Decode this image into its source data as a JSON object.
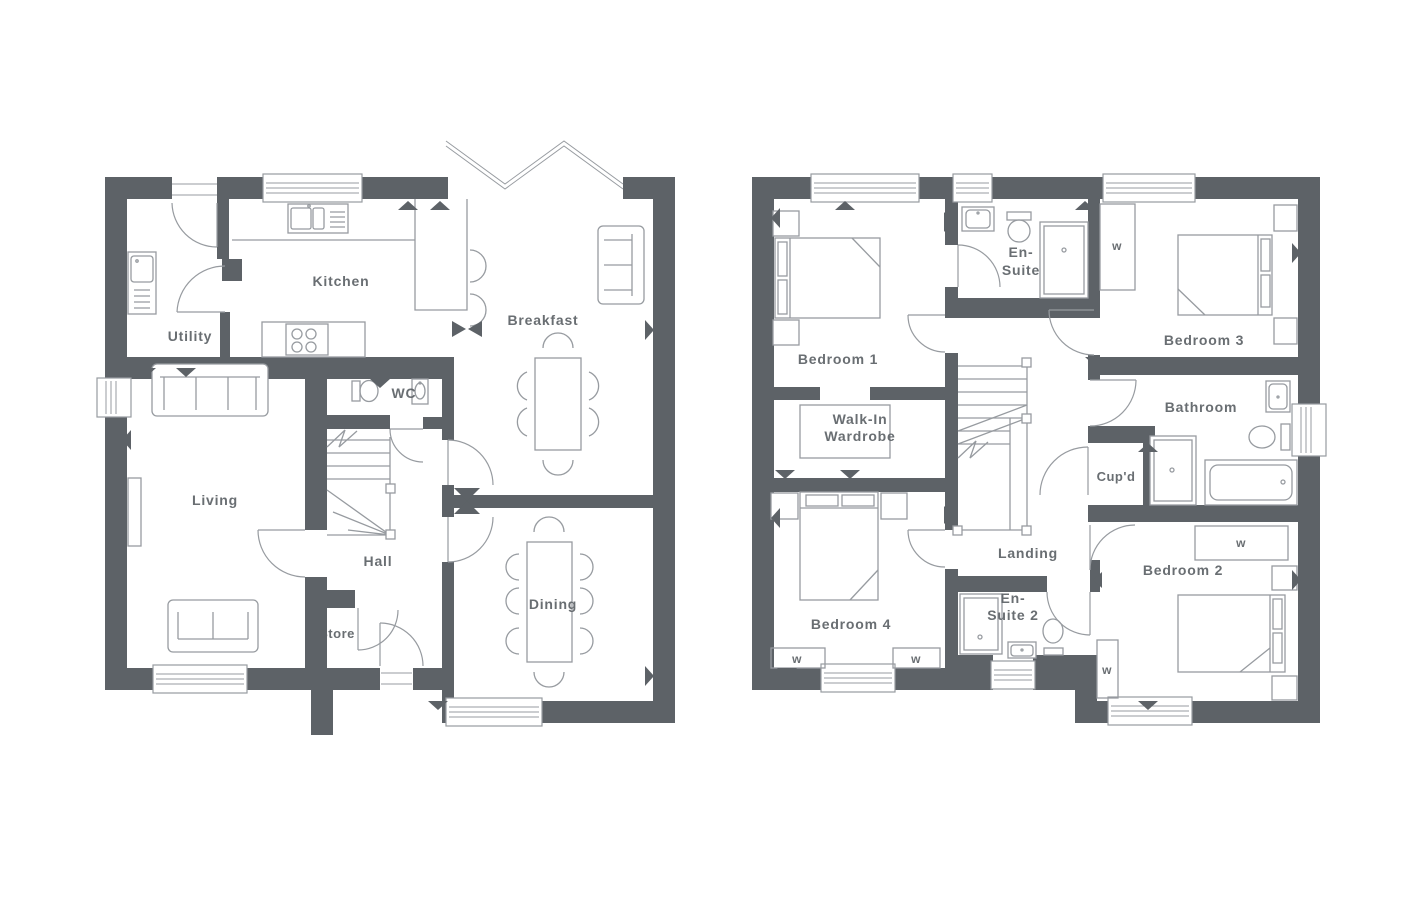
{
  "colors": {
    "wall": "#5d6267",
    "line": "#979ba0",
    "text": "#5d6267",
    "background": "#ffffff"
  },
  "ground_floor": {
    "labels": {
      "kitchen": "Kitchen",
      "breakfast": "Breakfast",
      "utility": "Utility",
      "wc": "WC",
      "living": "Living",
      "hall": "Hall",
      "store": "Store",
      "dining": "Dining"
    }
  },
  "first_floor": {
    "labels": {
      "bedroom1": "Bedroom 1",
      "bedroom2": "Bedroom 2",
      "bedroom3": "Bedroom 3",
      "bedroom4": "Bedroom 4",
      "ensuite_line1": "En-",
      "ensuite_line2": "Suite",
      "ensuite2_line1": "En-",
      "ensuite2_line2": "Suite 2",
      "walkin_line1": "Walk-In",
      "walkin_line2": "Wardrobe",
      "bathroom": "Bathroom",
      "cupboard": "Cup'd",
      "landing": "Landing",
      "wardrobe_mark": "w"
    }
  }
}
